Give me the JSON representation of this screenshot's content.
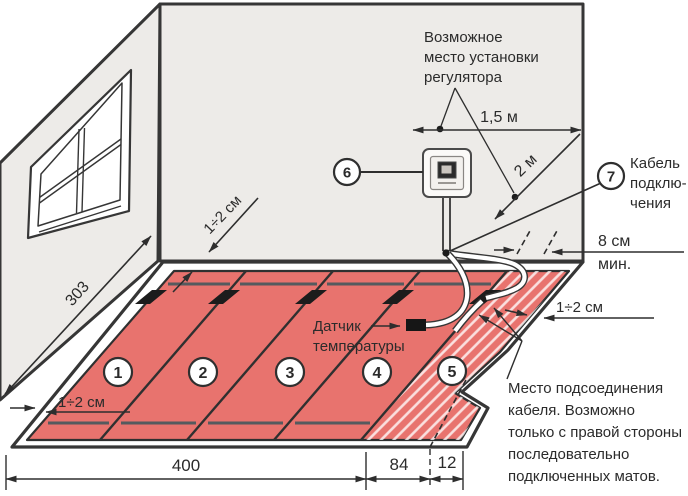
{
  "labels": {
    "regulator_note": [
      "Возможное",
      "место установки",
      "регулятора"
    ],
    "dim_1_5m": "1,5 м",
    "dim_2m": "2 м",
    "callout_6": "6",
    "callout_7": "7",
    "cable_label": [
      "Кабель",
      "подклю-",
      "чения"
    ],
    "min_gap": [
      "8 см",
      "мин."
    ],
    "gap_right": "1÷2 см",
    "gap_back": "1÷2 см",
    "gap_left": "1÷2 см",
    "sensor_label": [
      "Датчик",
      "температуры"
    ],
    "wall_length": "303",
    "mat_numbers": [
      "1",
      "2",
      "3",
      "4",
      "5"
    ],
    "bottom_dims": {
      "d400": "400",
      "d84": "84",
      "d12": "12"
    },
    "connection_note": [
      "Место подсоединения",
      "кабеля. Возможно",
      "только с правой стороны",
      "последовательно",
      "подключенных матов."
    ]
  },
  "colors": {
    "mat_red": "#e8736e",
    "wall_gray": "#edebe8",
    "outline_dark": "#363636",
    "heat_line_gray": "#555a5e",
    "connector_black": "#1c1c1c"
  }
}
